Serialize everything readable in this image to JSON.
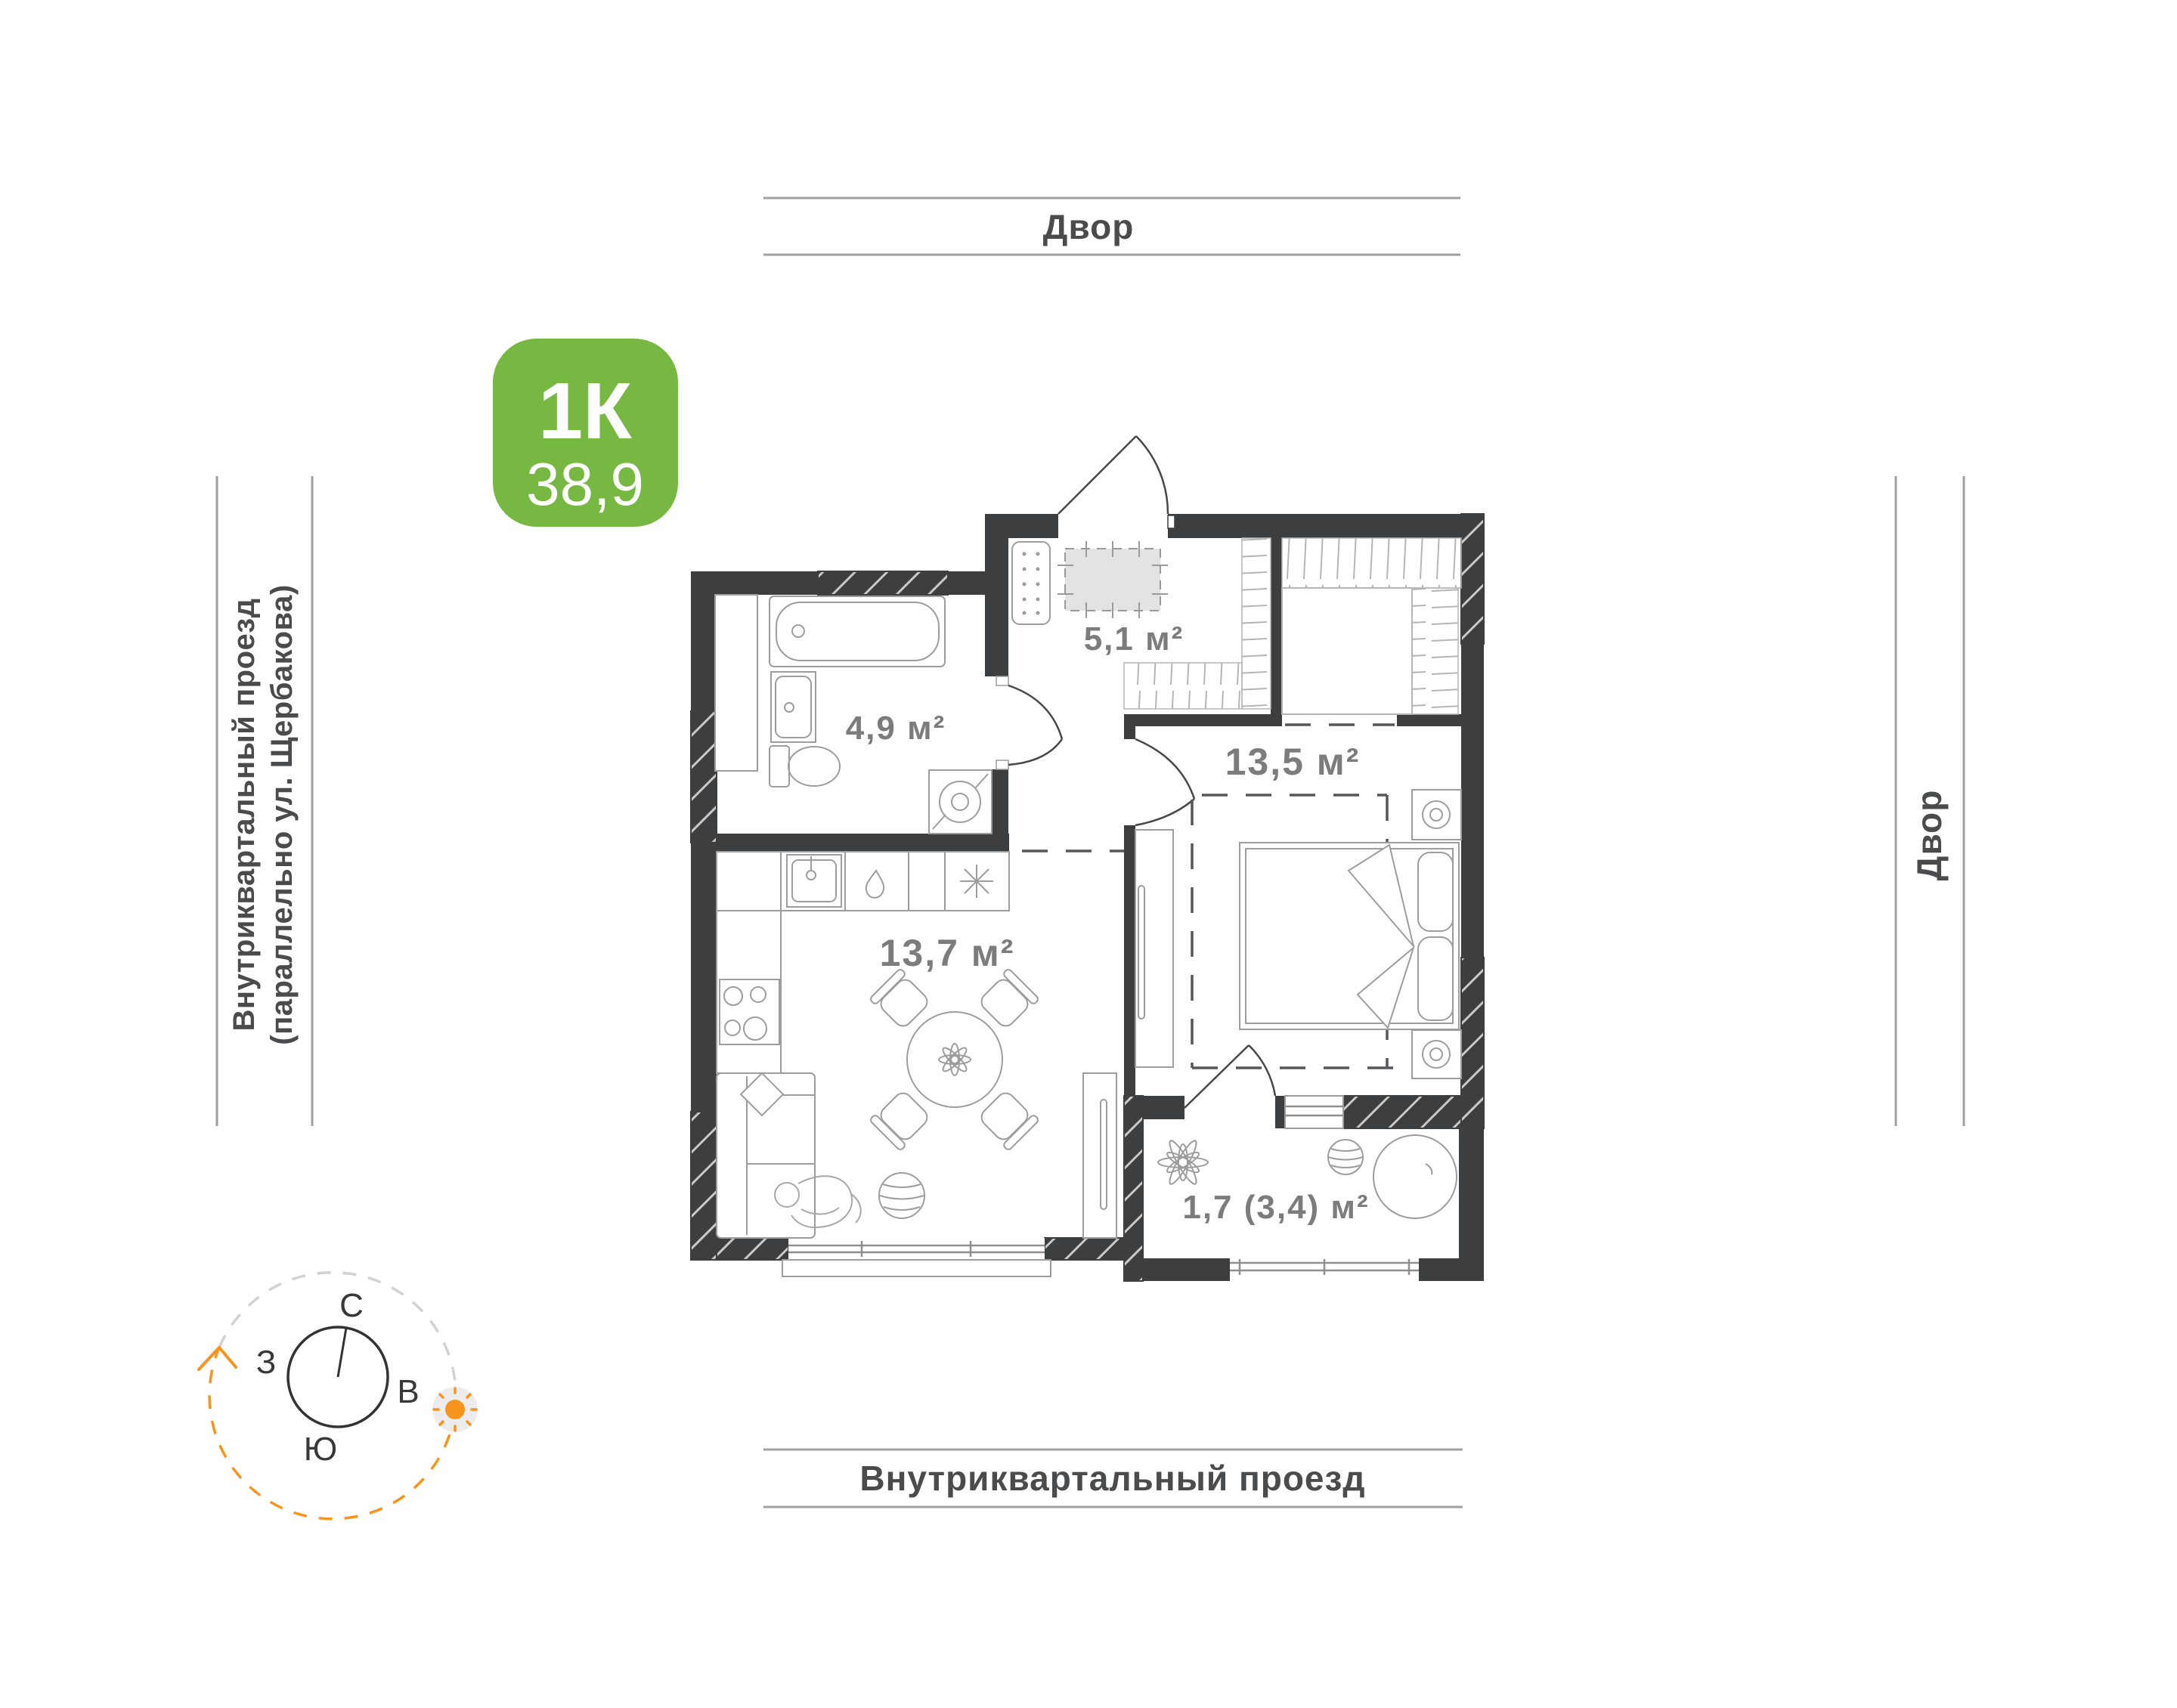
{
  "badge": {
    "type_label": "1К",
    "area_value": "38,9"
  },
  "rooms": {
    "hallway": {
      "area": "5,1 м²"
    },
    "bathroom": {
      "area": "4,9 м²"
    },
    "bedroom": {
      "area": "13,5 м²"
    },
    "kitchen_living": {
      "area": "13,7 м²"
    },
    "balcony": {
      "area": "1,7 (3,4) м²"
    }
  },
  "surroundings": {
    "top": "Двор",
    "right": "Двор",
    "bottom": "Внутриквартальный проезд",
    "left_line1": "Внутриквартальный проезд",
    "left_line2": "(параллельно ул. Щербакова)"
  },
  "compass": {
    "north": "С",
    "south": "Ю",
    "west": "З",
    "east": "В"
  },
  "colors": {
    "badge_green": "#77b843",
    "wall_dark": "#3d3e40",
    "accent_orange": "#f7941e",
    "room_label_gray": "#7c7c7e",
    "street_label_gray": "#4a4b4d",
    "band_line_gray": "#9f9f9f"
  }
}
